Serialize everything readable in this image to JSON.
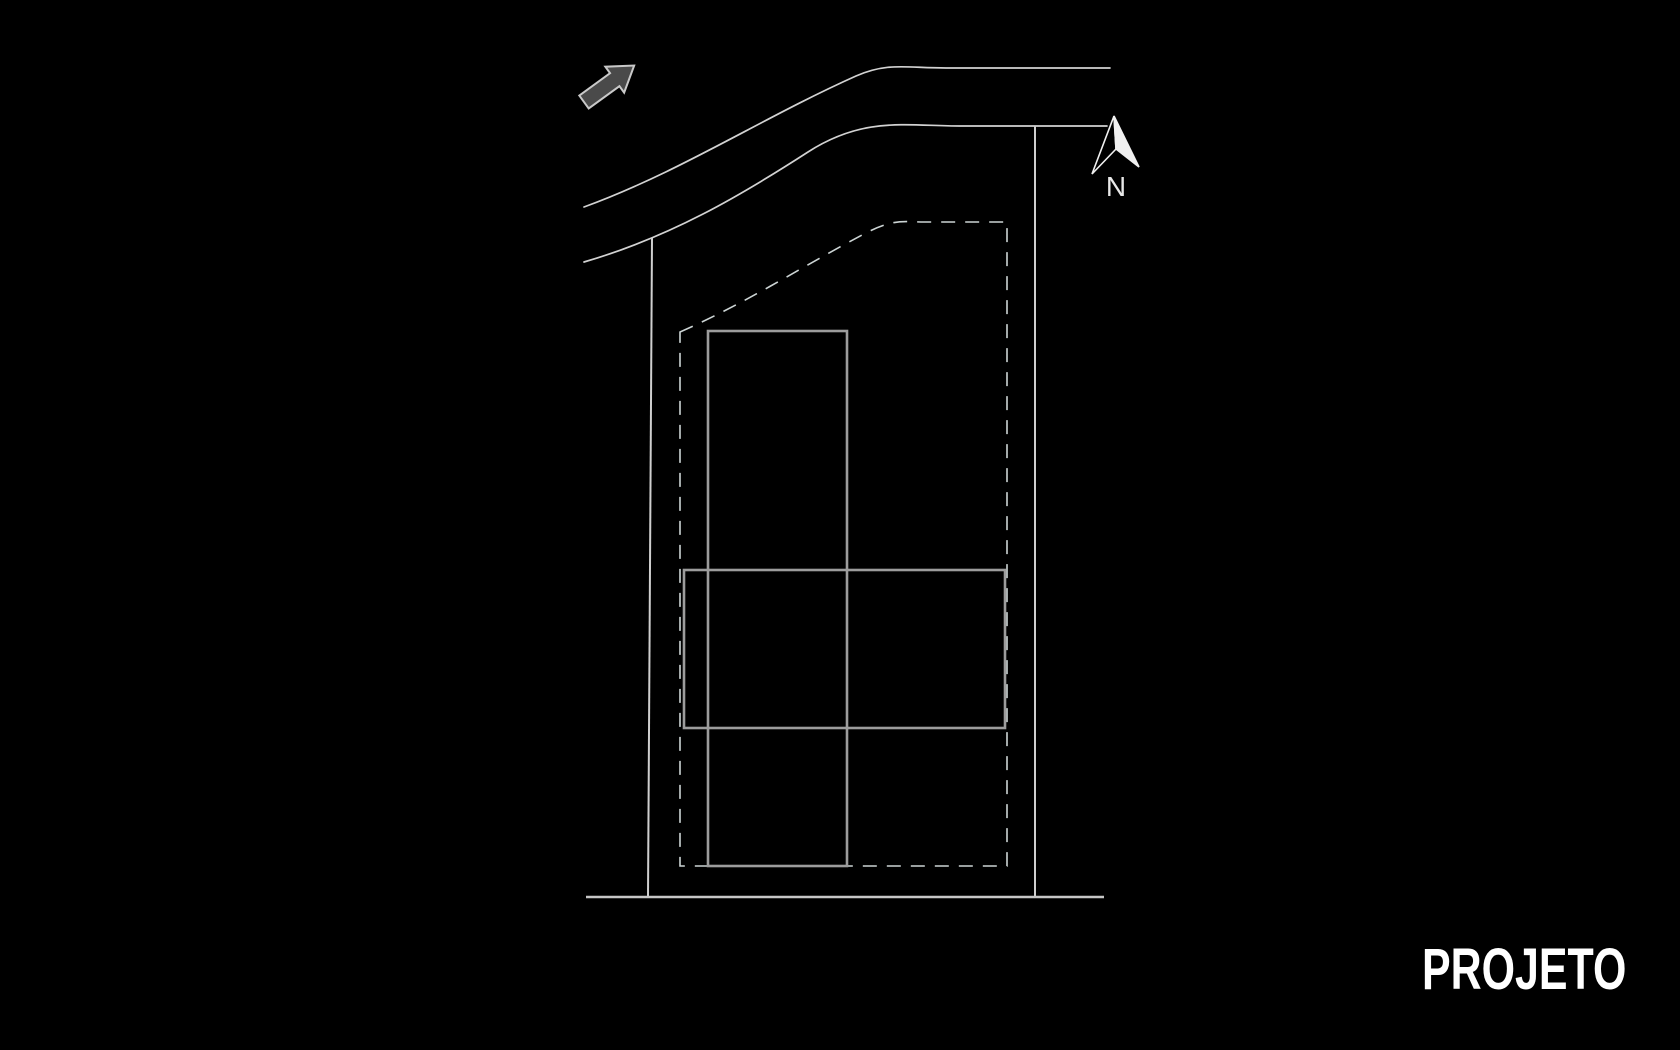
{
  "title": {
    "label": "PROJETO"
  },
  "compass": {
    "north_label": "N"
  },
  "drawing": {
    "background_color": "#000000",
    "street_line_color": "#d2d2d2",
    "boundary_line_color": "#cfcfcf",
    "setback_line_color": "#ccd4d4",
    "building_line_color": "#9c9c9c",
    "direction_arrow_fill": "#4a4a4a",
    "direction_arrow_outline": "#c9c9c9",
    "north_arrow_color": "#f0f0f0",
    "title_color": "#ffffff"
  }
}
